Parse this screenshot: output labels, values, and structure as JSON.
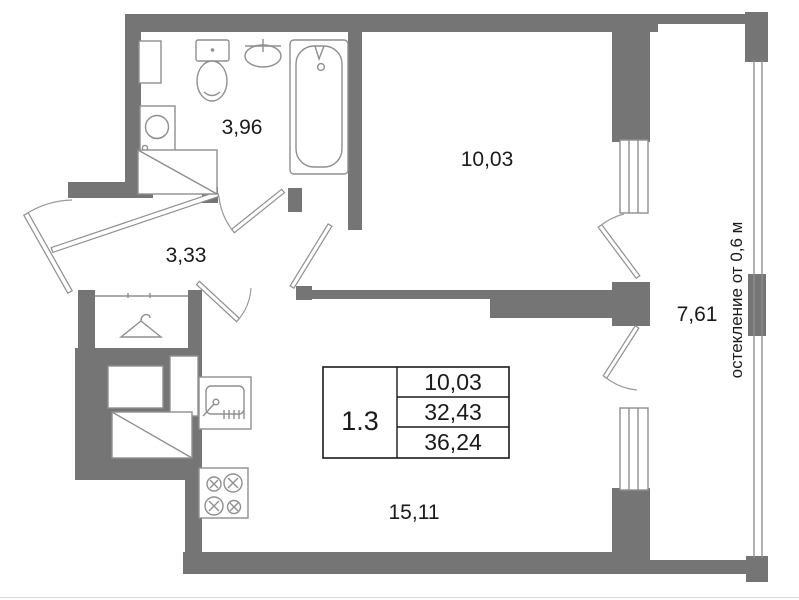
{
  "floor_plan": {
    "info_table": {
      "left_cell": "1.3",
      "rows": [
        "10,03",
        "32,43",
        "36,24"
      ]
    },
    "rooms": {
      "bathroom": {
        "area": "3,96"
      },
      "hallway": {
        "area": "3,33"
      },
      "bedroom": {
        "area": "10,03"
      },
      "living_kitchen": {
        "area": "15,11"
      },
      "balcony": {
        "area": "7,61"
      }
    },
    "balcony_note": "остекление от 0,6 м",
    "colors": {
      "wall": "#757575",
      "fixture_line": "#8f8f8f",
      "text": "#1a1a1a",
      "background": "#ffffff"
    }
  }
}
